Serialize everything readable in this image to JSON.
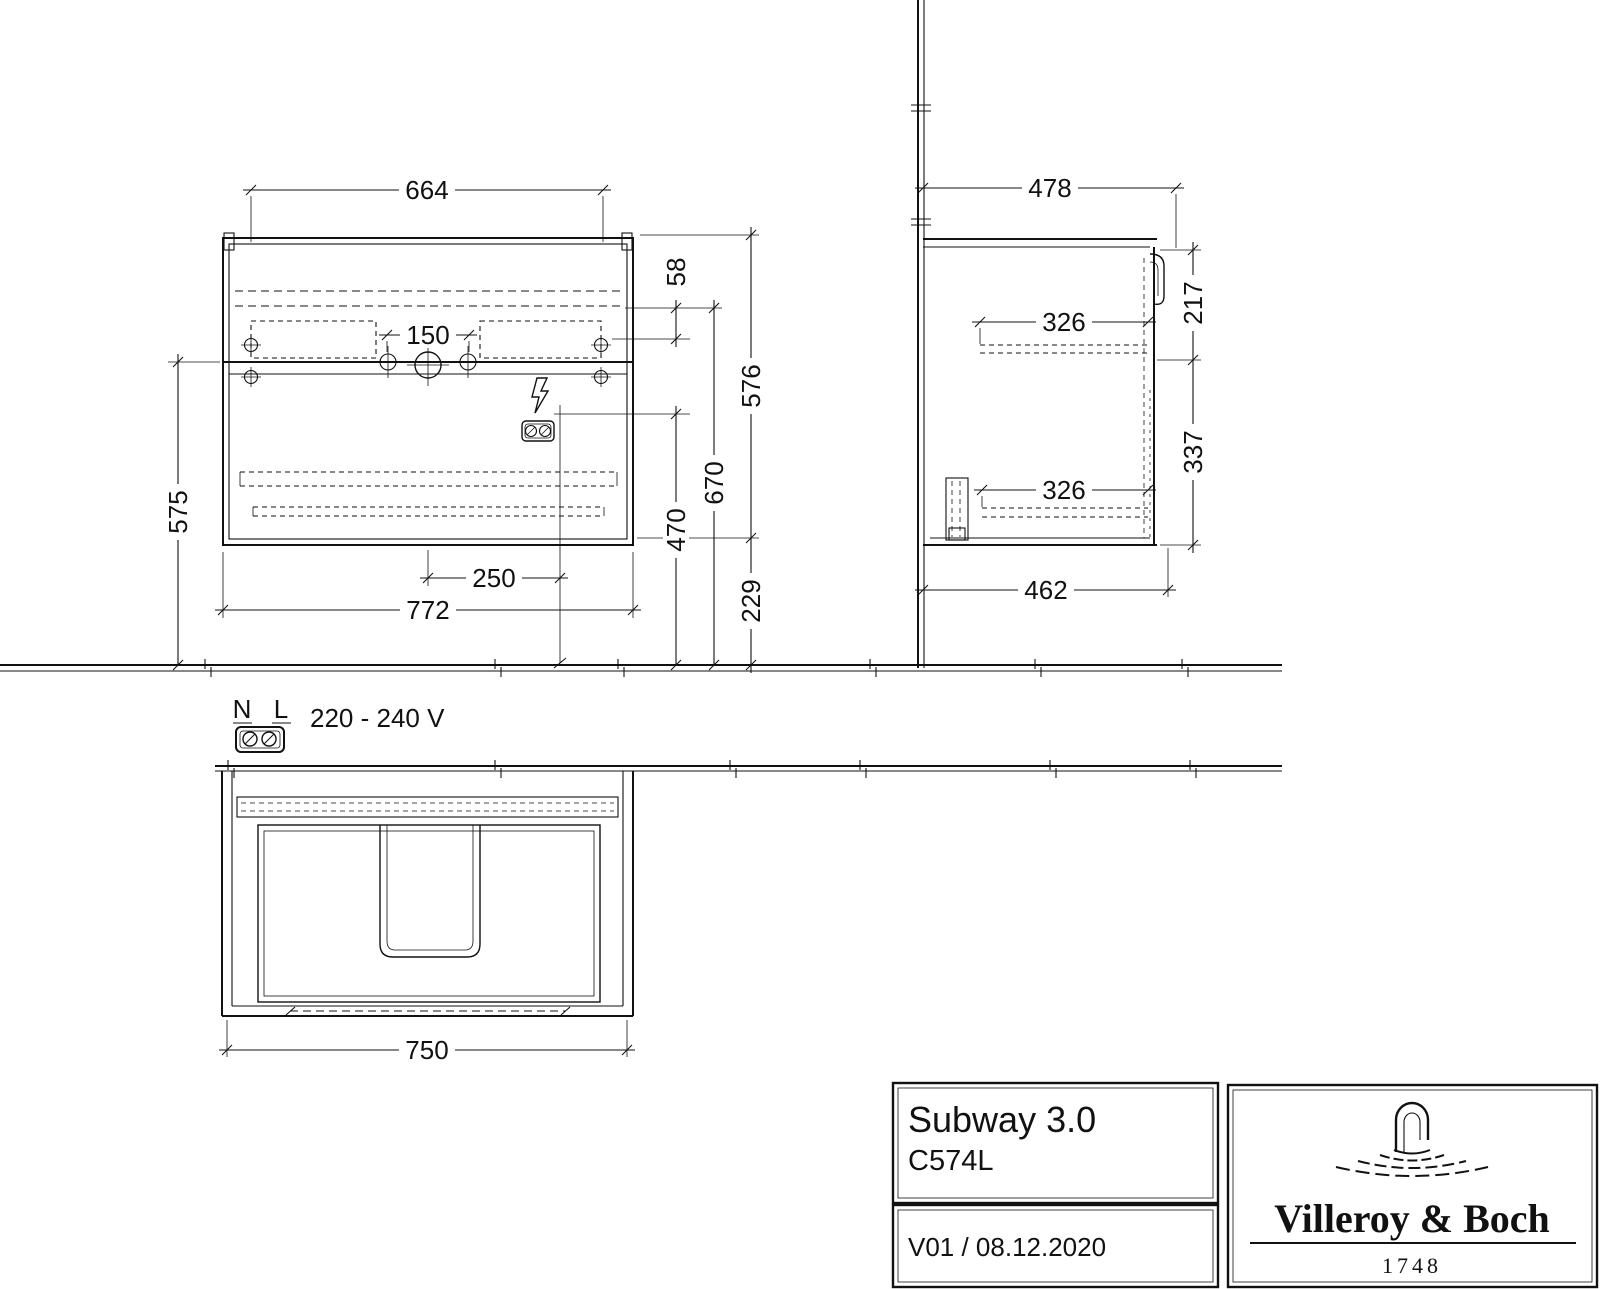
{
  "drawing": {
    "front": {
      "dim_inner_width": "664",
      "dim_tap_distance": "150",
      "dim_rail_offset": "58",
      "dim_height": "576",
      "dim_rail_height": "670",
      "dim_outlet_height": "470",
      "dim_bottom_clearance": "229",
      "dim_mount_height": "575",
      "dim_outlet_offset": "250",
      "dim_total_width": "772"
    },
    "side": {
      "dim_depth": "478",
      "dim_top_front": "217",
      "dim_drawer_top": "326",
      "dim_bottom_front": "337",
      "dim_drawer_bottom": "326",
      "dim_carcass_depth": "462"
    },
    "plan": {
      "dim_width": "750"
    },
    "electrical": {
      "neutral": "N",
      "live": "L",
      "voltage": "220 - 240 V"
    }
  },
  "title_block": {
    "series": "Subway 3.0",
    "model": "C574L",
    "revision": "V01 / 08.12.2020",
    "brand": "Villeroy & Boch",
    "since": "1748"
  }
}
